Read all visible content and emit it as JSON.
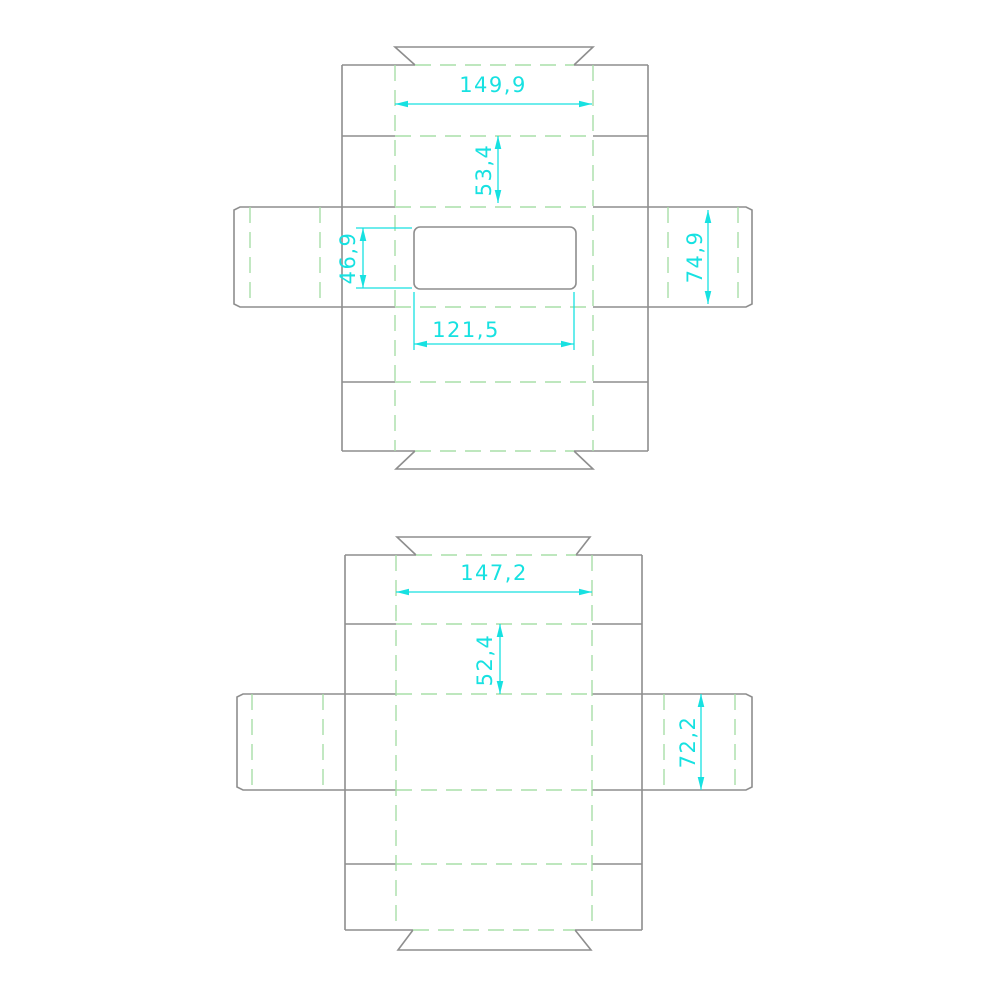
{
  "canvas": {
    "background": "#ffffff"
  },
  "colors": {
    "cut": "#8e8e8e",
    "fold": "#a8dfa8",
    "dimension": "#17e1e1"
  },
  "drawings": [
    {
      "id": "dieline-with-window",
      "labels": {
        "panel_width": "149,9",
        "upper_panel_height": "53,4",
        "window_height": "46,9",
        "side_flap_height": "74,9",
        "window_width": "121,5"
      }
    },
    {
      "id": "dieline-plain",
      "labels": {
        "panel_width": "147,2",
        "upper_panel_height": "52,4",
        "side_flap_height": "72,2"
      }
    }
  ]
}
